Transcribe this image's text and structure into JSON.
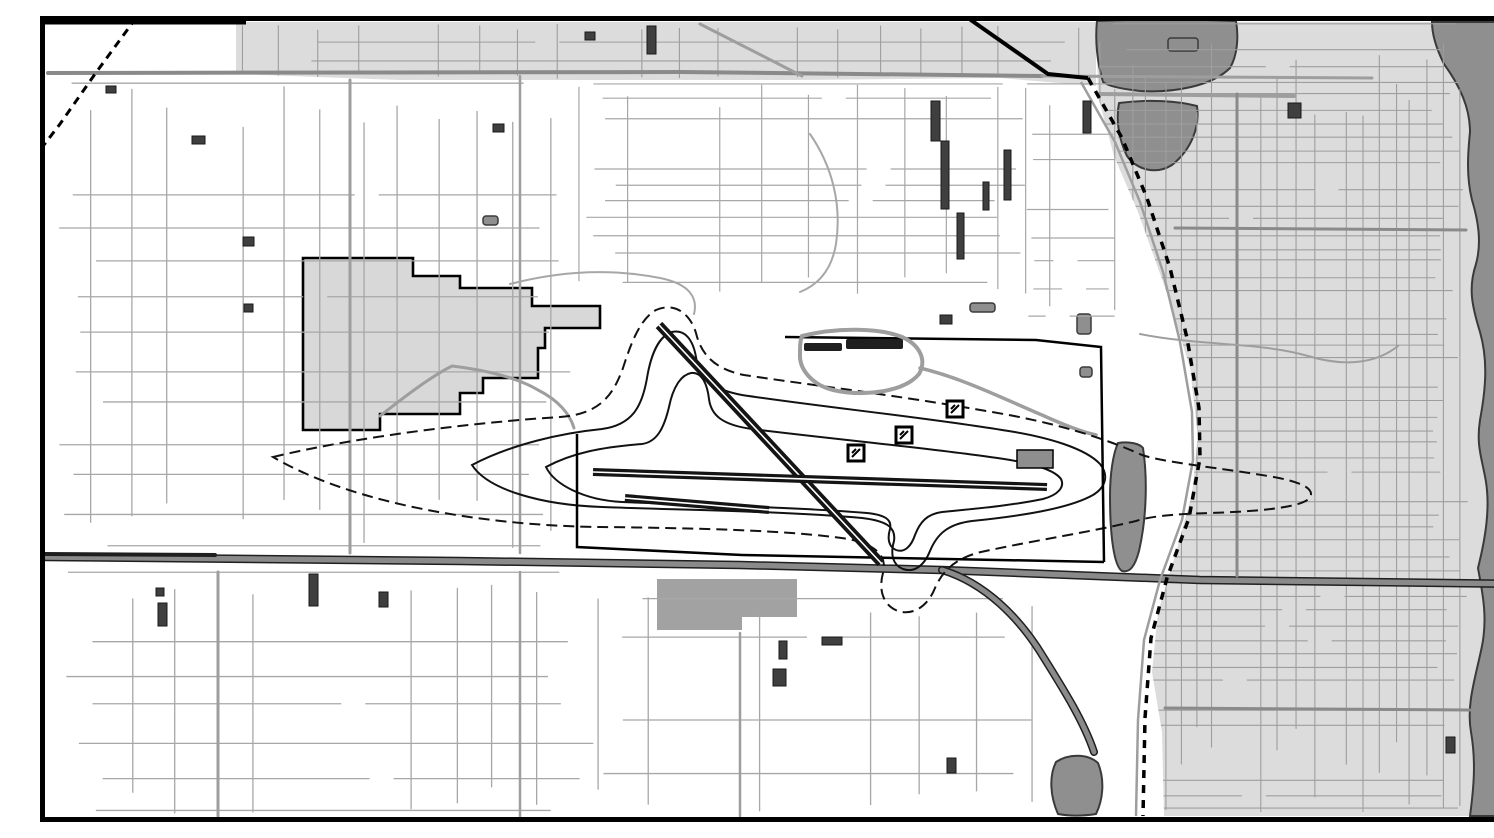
{
  "meta": {
    "width": 1494,
    "height": 806,
    "kind": "grayscale-gis-airport-noise-map"
  },
  "palette": {
    "background": "#ffffff",
    "frame": "#000000",
    "street": "#a7a7a7",
    "urban_street": "#9e9e9e",
    "major_road": "#8a8a8a",
    "casing": "#1f1f1f",
    "urban_fill": "#dcdcdc",
    "parcel_fill": "#d8d8d8",
    "parcel_dark": "#a2a2a2",
    "water_fill": "#8f8f8f",
    "shore": "#3a3a3a",
    "runway": "#141414",
    "contour": "#121212",
    "boundary": "#000000",
    "building": "#3f3f3f",
    "apron": "#8e8e8e"
  },
  "map": {
    "clips": [
      {
        "id": "clip-right",
        "path": "M1056,6 L1490,6 L1490,800 L1124,800 L1122,716 L1112,656 L1118,596 L1136,536 L1152,478 L1158,420 L1150,352 L1128,280 L1098,196 L1074,140 L1058,80 Z"
      },
      {
        "id": "clip-band",
        "path": "M196,6 L1056,6 L1056,70 L960,62 L760,64 L560,64 L360,64 L196,58 Z"
      }
    ],
    "urban_areas": [
      {
        "name": "urban-area-east",
        "path": "M1056,6 L1490,6 L1490,800 L1124,800 L1122,716 L1112,656 L1118,596 L1136,536 L1152,478 L1158,420 L1150,352 L1128,280 L1098,196 L1074,140 L1058,80 Z",
        "fill": "urban_fill"
      },
      {
        "name": "urban-band-top",
        "path": "M196,6 L1056,6 L1056,70 L960,62 L760,64 L560,64 L360,64 L196,58 Z",
        "fill": "urban_fill"
      },
      {
        "name": "parcel-west-bordered",
        "path": "M263,242 L373,242 L373,260 L420,260 L420,272 L492,272 L492,290 L560,290 L560,312 L505,312 L505,332 L498,332 L498,362 L443,362 L443,377 L420,377 L420,398 L340,398 L340,414 L263,414 Z",
        "fill": "parcel_fill",
        "stroke": "boundary",
        "stroke_width": 2.6
      },
      {
        "name": "parcel-south-gray",
        "path": "M617,563 L757,563 L757,601 L702,601 L702,614 L617,614 Z",
        "fill": "parcel_dark"
      }
    ],
    "water": [
      {
        "name": "lake-upper-lobe",
        "path": "M1057,5 C1104,3 1152,3 1196,5 C1199,22 1197,40 1190,52 C1172,70 1134,77 1100,75 C1082,73 1068,70 1063,66 C1057,46 1055,24 1057,5 Z"
      },
      {
        "name": "lake-lower-lobe",
        "path": "M1079,87 C1108,83 1138,85 1157,90 C1160,110 1152,133 1132,149 C1116,159 1097,154 1087,140 C1078,122 1076,102 1079,87 Z"
      },
      {
        "name": "river-east-strip",
        "path": "M1392,6 L1489,6 L1489,800 L1430,800 C1434,770 1436,745 1431,716 C1426,688 1436,660 1442,630 C1448,600 1442,575 1438,552 C1446,520 1450,492 1446,466 C1442,442 1436,430 1440,404 C1446,372 1448,344 1440,316 C1432,290 1428,272 1436,248 C1442,226 1438,204 1432,184 C1426,160 1428,136 1430,116 C1430,92 1420,70 1404,48 C1396,32 1392,18 1392,6 Z"
      },
      {
        "name": "pond-south",
        "path": "M1016,746 C1028,738 1047,737 1058,747 C1065,764 1063,784 1056,798 C1043,800 1029,800 1018,798 C1010,780 1009,760 1016,746 Z"
      },
      {
        "name": "valley-strip-east-of-airport",
        "path": "M1078,427 C1090,425 1100,428 1103,432 C1108,465 1106,505 1099,535 C1095,550 1090,557 1082,555 C1074,550 1070,520 1070,480 C1070,458 1073,438 1078,427 Z"
      }
    ],
    "gray_blobs": [
      {
        "name": "gray-blob-band",
        "x": 1128,
        "y": 22,
        "w": 30,
        "h": 13
      },
      {
        "name": "gray-blob-apron-north",
        "x": 930,
        "y": 287,
        "w": 25,
        "h": 9
      },
      {
        "name": "gray-blob-east1",
        "x": 1037,
        "y": 298,
        "w": 14,
        "h": 20
      },
      {
        "name": "gray-blob-east2",
        "x": 1040,
        "y": 351,
        "w": 12,
        "h": 10
      },
      {
        "name": "gray-blob-west-pond",
        "x": 443,
        "y": 200,
        "w": 15,
        "h": 9
      }
    ],
    "grids": [
      {
        "name": "street-grid-west",
        "x0": 16,
        "x1": 532,
        "y0": 66,
        "y1": 538,
        "dx": 38,
        "dy": 36,
        "seed": 7,
        "skip": 0.18,
        "jitter": 10,
        "color": "street",
        "width": 1.3
      },
      {
        "name": "street-grid-southwest",
        "x0": 16,
        "x1": 560,
        "y0": 556,
        "y1": 798,
        "dx": 40,
        "dy": 34,
        "seed": 11,
        "skip": 0.2,
        "jitter": 10,
        "color": "street",
        "width": 1.3
      },
      {
        "name": "street-grid-south-center",
        "x0": 560,
        "x1": 1005,
        "y0": 578,
        "y1": 798,
        "dx": 54,
        "dy": 44,
        "seed": 13,
        "skip": 0.28,
        "jitter": 12,
        "color": "street",
        "width": 1.3
      },
      {
        "name": "street-grid-north-center",
        "x0": 540,
        "x1": 985,
        "y0": 66,
        "y1": 282,
        "dx": 46,
        "dy": 17,
        "seed": 17,
        "skip": 0.22,
        "jitter": 8,
        "color": "street",
        "width": 1.2
      },
      {
        "name": "street-grid-east-city",
        "x0": 1058,
        "x1": 1428,
        "y0": 8,
        "y1": 800,
        "dx": 16.5,
        "dy": 14,
        "seed": 19,
        "skip": 0.15,
        "jitter": 5,
        "color": "urban_street",
        "width": 1.1,
        "clip": "clip-right"
      },
      {
        "name": "street-grid-top-band",
        "x0": 200,
        "x1": 1052,
        "y0": 8,
        "y1": 64,
        "dx": 40,
        "dy": 18,
        "seed": 23,
        "skip": 0.2,
        "jitter": 6,
        "color": "urban_street",
        "width": 1.1,
        "clip": "clip-band"
      },
      {
        "name": "street-grid-pocket-ne",
        "x0": 986,
        "x1": 1076,
        "y0": 66,
        "y1": 300,
        "dx": 22,
        "dy": 26,
        "seed": 29,
        "skip": 0.25,
        "jitter": 7,
        "color": "street",
        "width": 1.2
      }
    ],
    "roads": [
      {
        "name": "road-top-horizontal",
        "path": "M8,57 L640,56 L1002,60",
        "color": "major_road",
        "width": 4
      },
      {
        "name": "road-band-extension",
        "path": "M1002,60 L1332,62",
        "color": "urban_street",
        "width": 3
      },
      {
        "name": "road-lake-crossing",
        "path": "M1060,78 L1254,80",
        "color": "urban_street",
        "width": 4
      },
      {
        "name": "road-vertical-west-1",
        "path": "M310,64 L310,537",
        "color": "urban_street",
        "width": 3
      },
      {
        "name": "road-vertical-west-2",
        "path": "M480,60 L480,537",
        "color": "urban_street",
        "width": 2.5
      },
      {
        "name": "road-vertical-west-2-south",
        "path": "M480,556 L480,800",
        "color": "urban_street",
        "width": 2.5
      },
      {
        "name": "road-vertical-southwest",
        "path": "M178,556 L178,800",
        "color": "urban_street",
        "width": 3
      },
      {
        "name": "road-vertical-south-center",
        "path": "M700,617 L700,800",
        "color": "urban_street",
        "width": 2.5
      },
      {
        "name": "highway-bottom",
        "path": "M6,541 L420,545 L700,549 L902,554 L1160,564 L1489,568",
        "color": "major_road",
        "width": 5.5,
        "casing": true
      },
      {
        "name": "highway-bottom-black-segment",
        "path": "M4,538 L175,539",
        "color": "casing",
        "width": 4
      },
      {
        "name": "highway-diagonal-southeast",
        "path": "M902,554 C945,567 980,602 1004,642 C1024,674 1044,706 1054,736",
        "color": "major_road",
        "width": 5,
        "casing": true
      },
      {
        "name": "road-east-major-h1",
        "path": "M1135,212 L1426,214",
        "color": "major_road",
        "width": 3
      },
      {
        "name": "road-east-major-h2",
        "path": "M1125,692 L1430,694",
        "color": "major_road",
        "width": 3
      },
      {
        "name": "road-east-major-v",
        "path": "M1197,78 L1197,560",
        "color": "major_road",
        "width": 3
      },
      {
        "name": "creek-top-center",
        "path": "M770,118 C792,150 802,188 796,228 C792,252 780,268 760,276",
        "color": "street",
        "width": 2
      },
      {
        "name": "creek-west-of-airport",
        "path": "M470,268 C520,255 570,252 620,262 C650,268 658,282 654,298",
        "color": "street",
        "width": 2
      },
      {
        "name": "creek-east-city",
        "path": "M1100,318 C1160,330 1220,326 1268,340 C1308,352 1338,346 1358,330",
        "color": "urban_street",
        "width": 2
      },
      {
        "name": "road-band-diagonal",
        "path": "M660,8 L762,60",
        "color": "urban_street",
        "width": 3
      },
      {
        "name": "road-terminal-connector",
        "path": "M880,352 C922,362 962,382 1002,399 C1024,409 1042,416 1056,419",
        "color": "urban_street",
        "width": 3.5
      },
      {
        "name": "road-west-access-loop",
        "path": "M340,400 C368,378 392,360 412,350 C446,354 478,362 498,374 C518,384 530,398 534,412",
        "color": "urban_street",
        "width": 3
      }
    ],
    "railroads": [
      {
        "name": "railroad-northwest",
        "path": "M96,2 L55,58 L20,108 L0,134",
        "dash": "8 6",
        "width": 3
      },
      {
        "name": "railroad-northeast",
        "path": "M1048,62 L1082,122 L1107,182 L1130,252 L1147,322 L1159,392 L1160,442 L1149,502 L1127,562 L1111,622 L1105,702 L1103,800",
        "dash": "8 7",
        "width": 3.5,
        "parallel": "M1041,66 L1075,126 L1100,186 L1123,256 L1140,326 L1152,396 L1153,444 L1142,504 L1120,564 L1104,624 L1098,704 L1096,800"
      },
      {
        "name": "highway-northeast-solid",
        "path": "M928,2 L1008,58 L1048,62",
        "dash": null,
        "width": 4
      }
    ],
    "airport": {
      "noise_contours": [
        {
          "name": "noise-contour-outer",
          "dash": "11 6",
          "width": 2,
          "path": "M233,441 C320,420 440,406 520,401 C558,398 572,382 583,352 C591,327 600,303 616,294 C634,286 650,297 656,317 C661,338 674,353 704,359 C770,369 856,379 952,396 C1012,406 1062,421 1102,439 C1122,446 1180,452 1228,460 C1258,465 1272,471 1271,479 C1270,490 1230,495 1170,497 C1130,498 1108,501 1096,505 C1046,517 996,524 941,536 C916,542 903,554 895,572 C888,590 873,600 858,595 C844,590 838,575 843,557 C847,541 838,529 808,523 C750,514 650,512 560,511 C460,510 320,492 233,441 Z"
        },
        {
          "name": "noise-contour-middle",
          "dash": null,
          "width": 2,
          "path": "M432,449 C472,428 522,417 562,413 C592,409 602,391 607,362 C611,338 619,320 632,316 C645,313 653,324 656,341 C659,361 670,373 702,379 C782,391 882,401 962,414 C1010,421 1046,433 1060,448 C1069,459 1066,471 1053,479 C1028,493 980,500 932,505 C908,508 897,518 890,535 C884,550 874,557 863,553 C853,549 850,539 854,525 C856,512 848,505 822,502 C742,495 642,494 562,491 C502,489 448,474 432,449 Z"
        },
        {
          "name": "noise-contour-inner",
          "dash": null,
          "width": 2,
          "path": "M506,451 C532,437 562,431 602,428 C617,426 624,412 629,391 C633,371 641,359 651,357 C661,356 667,366 669,383 C671,399 682,409 712,413 C792,423 880,431 950,441 C989,446 1014,453 1021,463 C1025,471 1018,479 1003,483 C969,490 931,493 902,496 C887,498 880,506 875,519 C871,531 864,537 856,534 C849,531 847,523 850,513 C852,504 846,499 827,497 C752,491 652,489 582,486 C543,484 514,468 506,451 Z"
        }
      ],
      "boundary": [
        {
          "name": "airport-boundary-west-south",
          "path": "M537,418 L537,531 L702,539"
        },
        {
          "name": "airport-boundary-south",
          "path": "M702,539 L1064,546"
        },
        {
          "name": "airport-boundary-east-north",
          "path": "M1064,546 L1061,331 L996,324 L745,321"
        }
      ],
      "runways": [
        {
          "name": "runway-diagonal",
          "x1": 619,
          "y1": 309,
          "x2": 841,
          "y2": 547,
          "width": 9
        },
        {
          "name": "runway-main-horizontal",
          "x1": 553,
          "y1": 456,
          "x2": 1007,
          "y2": 471,
          "width": 8
        },
        {
          "name": "runway-secondary-horizontal",
          "x1": 585,
          "y1": 482,
          "x2": 729,
          "y2": 494,
          "width": 8
        }
      ],
      "terminal": {
        "loop_path": "M762,320 C798,311 840,312 862,321 C880,329 887,344 879,358 C864,376 824,381 793,374 C772,369 759,353 760,338 C760,331 760,325 762,320 Z",
        "bars": [
          [
            806,
            323,
            57,
            10
          ],
          [
            764,
            327,
            38,
            8
          ]
        ]
      },
      "apron": {
        "x": 977,
        "y": 434,
        "w": 36,
        "h": 18
      },
      "markers": [
        {
          "name": "field-marker-1",
          "x": 816,
          "y": 437
        },
        {
          "name": "field-marker-2",
          "x": 864,
          "y": 419
        },
        {
          "name": "field-marker-3",
          "x": 915,
          "y": 393
        }
      ]
    },
    "buildings": [
      [
        891,
        85,
        9,
        40
      ],
      [
        901,
        125,
        8,
        68
      ],
      [
        917,
        197,
        7,
        46
      ],
      [
        943,
        166,
        6,
        28
      ],
      [
        964,
        134,
        7,
        50
      ],
      [
        1043,
        85,
        8,
        32
      ],
      [
        152,
        120,
        13,
        8
      ],
      [
        66,
        70,
        10,
        7
      ],
      [
        203,
        221,
        11,
        9
      ],
      [
        204,
        288,
        9,
        8
      ],
      [
        453,
        108,
        11,
        8
      ],
      [
        118,
        587,
        9,
        23
      ],
      [
        269,
        558,
        9,
        32
      ],
      [
        339,
        576,
        9,
        15
      ],
      [
        116,
        572,
        8,
        8
      ],
      [
        739,
        625,
        8,
        18
      ],
      [
        782,
        621,
        20,
        8
      ],
      [
        733,
        653,
        13,
        17
      ],
      [
        907,
        742,
        9,
        15
      ],
      [
        607,
        10,
        9,
        28
      ],
      [
        545,
        16,
        10,
        8
      ],
      [
        900,
        299,
        12,
        9
      ],
      [
        1248,
        87,
        13,
        15
      ],
      [
        1406,
        721,
        9,
        16
      ]
    ],
    "frame": {
      "width": 5,
      "accent": {
        "x1": 0,
        "y1": 4,
        "x2": 206,
        "y2": 4,
        "width": 9
      }
    }
  }
}
